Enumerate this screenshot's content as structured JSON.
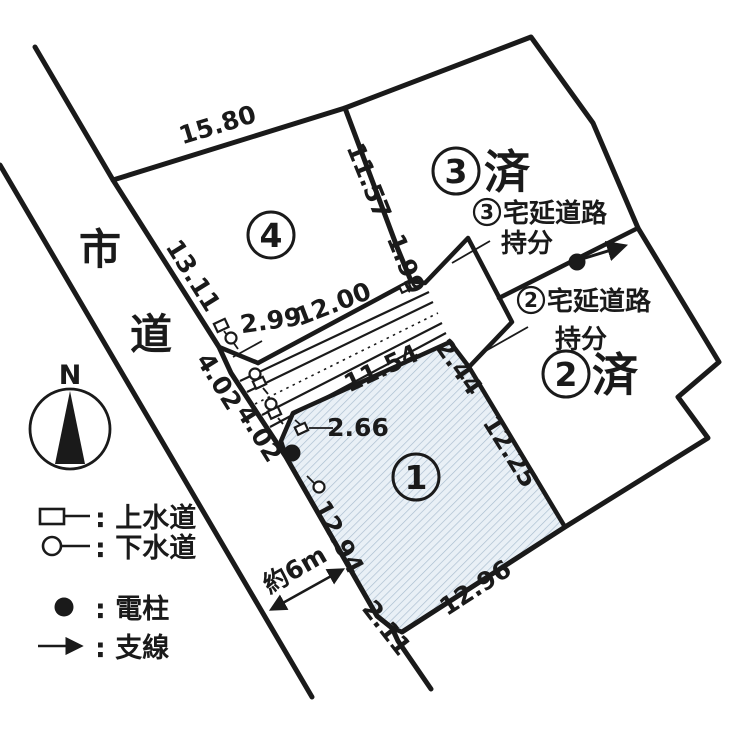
{
  "map": {
    "type": "cadastral-plot-diagram",
    "road": {
      "name_char1": "市",
      "name_char2": "道",
      "width_label": "約6m"
    },
    "compass": {
      "north_label": "N"
    },
    "plots": {
      "p1": {
        "number": "1",
        "status": ""
      },
      "p2": {
        "number": "2",
        "status": "済"
      },
      "p3": {
        "number": "3",
        "status": "済"
      },
      "p4": {
        "number": "4",
        "status": ""
      }
    },
    "share_labels": {
      "lot3": {
        "number": "3",
        "line1": "宅延道路",
        "line2": "持分"
      },
      "lot2": {
        "number": "2",
        "line1": "宅延道路",
        "line2": "持分"
      }
    },
    "measurements": {
      "m_1580": "15.80",
      "m_1311": "13.11",
      "m_1157": "11.57",
      "m_199": "1.99",
      "m_299": "2.99",
      "m_1200": "12.00",
      "m_402a": "4.02",
      "m_402b": "4.02",
      "m_266": "2.66",
      "m_1154": "11.54",
      "m_244": "2.44",
      "m_1225": "12.25",
      "m_1294": "12.94",
      "m_1296": "12.96",
      "m_211": "2.11"
    },
    "legend": {
      "water": ": 上水道",
      "sewer": ": 下水道",
      "pole": ": 電柱",
      "guywire": ": 支線"
    },
    "colors": {
      "line": "#1a1a1a",
      "hatch_bg": "#e9f0f6",
      "hatch_line": "#a8bcce"
    }
  }
}
